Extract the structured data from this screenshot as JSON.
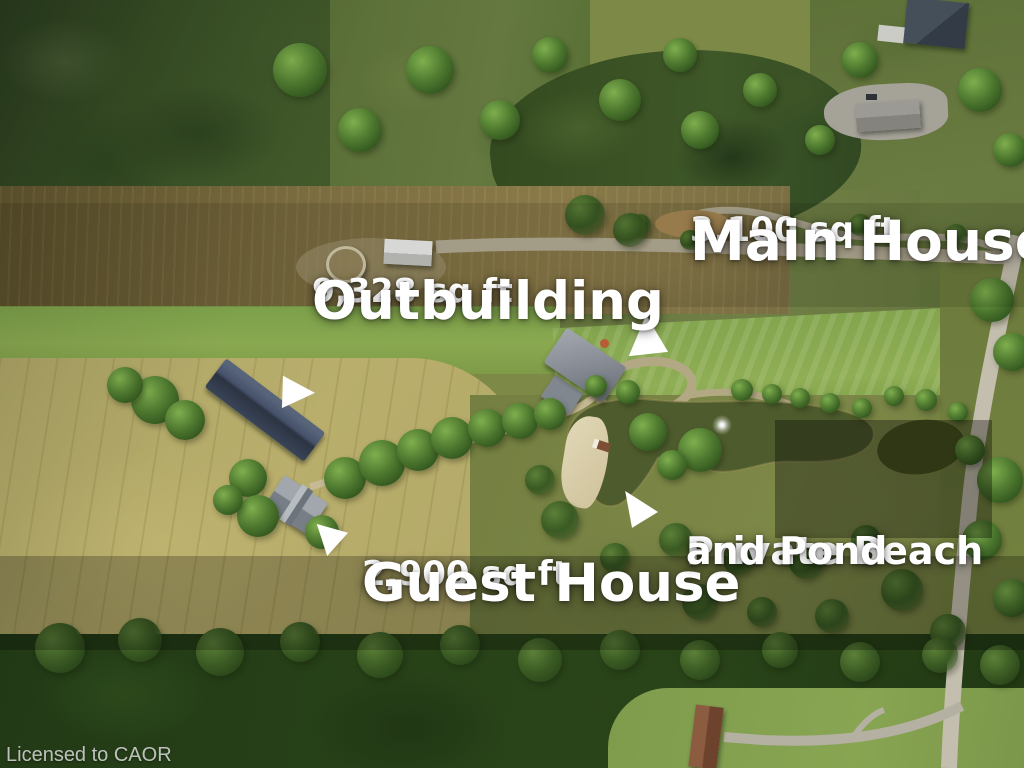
{
  "scene": {
    "description": "aerial drone photo of rural estate property"
  },
  "annotations": {
    "main_house": {
      "area": "3,100 sq ft",
      "label": "Main House"
    },
    "outbuilding": {
      "area": "9,328 sq ft",
      "label": "Outbuilding"
    },
    "guest_house": {
      "area": "2,900 sq ft",
      "label": "Guest House"
    },
    "beach_pond": {
      "line1": "Private Beach",
      "line2": "and Pond"
    }
  },
  "watermark": {
    "text": "Licensed to CAOR"
  },
  "colors": {
    "label_text": "#ffffff",
    "marker_fill": "#ffffff",
    "watermark_text": "#ebebeb",
    "pond_water": "#4e5c2d",
    "field_tan": "#b9ae6c",
    "forest_dark": "#2a4419"
  }
}
